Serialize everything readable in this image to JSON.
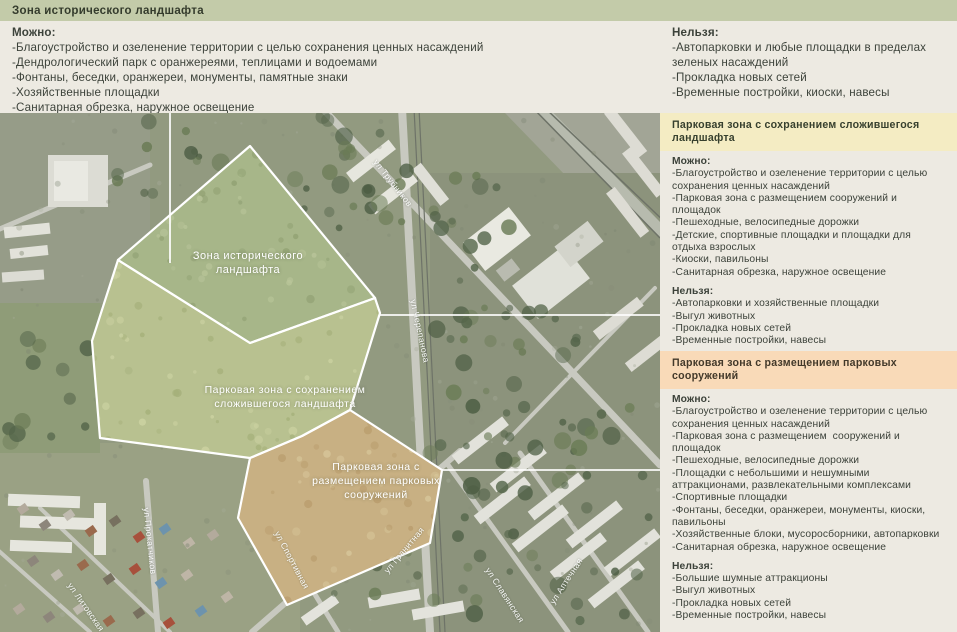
{
  "palette": {
    "background": "#edeae2",
    "band_historic": "#c3cba9",
    "band_preserve": "#f4ecc3",
    "band_constructions": "#f9dab8",
    "text": "#3c423a",
    "zone1_fill": "#a7b689",
    "zone2_fill": "#b8c190",
    "zone3_fill": "#c8b083"
  },
  "labels": {
    "can": "Можно:",
    "cannot": "Нельзя:"
  },
  "sections": {
    "historic": {
      "title": "Зона исторического ландшафта",
      "can": [
        "Благоустройство и озеленение территории с целью сохранения ценных насаждений",
        "Дендрологический парк с оранжереями, теплицами и водоемами",
        "Фонтаны, беседки, оранжереи, монументы, памятные знаки",
        "Хозяйственные площадки",
        "Санитарная обрезка, наружное освещение"
      ],
      "cannot": [
        "Автопарковки и любые площадки в пределах зеленых насаждений",
        "Прокладка новых сетей",
        "Временные постройки, киоски, навесы"
      ]
    },
    "preserve": {
      "title": "Парковая зона с сохранением сложившегося ландшафта",
      "can": [
        "Благоустройство и озеленение территории с целью сохранения ценных насаждений",
        "Парковая зона с размещением сооружений и площадок",
        "Пешеходные, велосипедные дорожки",
        "Детские, спортивные площадки и площадки для отдыха взрослых",
        "Киоски, павильоны",
        "Санитарная обрезка, наружное освещение"
      ],
      "cannot": [
        "Автопарковки и хозяйственные площадки",
        "Выгул животных",
        "Прокладка новых сетей",
        "Временные постройки, навесы"
      ]
    },
    "constructions": {
      "title": "Парковая зона с размещением парковых сооружений",
      "can": [
        "Благоустройство и озеленение территории с целью сохранения ценных насаждений",
        "Парковая зона с размещением  сооружений и площадок",
        "Пешеходные, велосипедные дорожки",
        "Площадки с небольшими и нешумными аттракционами, развлекательными комплексами",
        "Спортивные площадки",
        "Фонтаны, беседки, оранжереи, монументы, киоски, павильоны",
        "Хозяйственные блоки, мусоросборники, автопарковки",
        "Санитарная обрезка, наружное освещение"
      ],
      "cannot": [
        "Большие шумные аттракционы",
        "Выгул животных",
        "Прокладка новых сетей",
        "Временные постройки, навесы"
      ]
    }
  },
  "map": {
    "zones": [
      {
        "label": "Зона исторического ландшафта"
      },
      {
        "label": "Парковая зона с сохранением сложившегося ландшафта"
      },
      {
        "label": "Парковая зона с размещением парковых сооружений"
      }
    ],
    "streets": [
      "ул Трубников",
      "ул Черепанова",
      "ул Прокатчиков",
      "ул Литовская",
      "ул Спортивная",
      "ул Гранитная",
      "ул Славянская",
      "ул Аптечная"
    ]
  }
}
